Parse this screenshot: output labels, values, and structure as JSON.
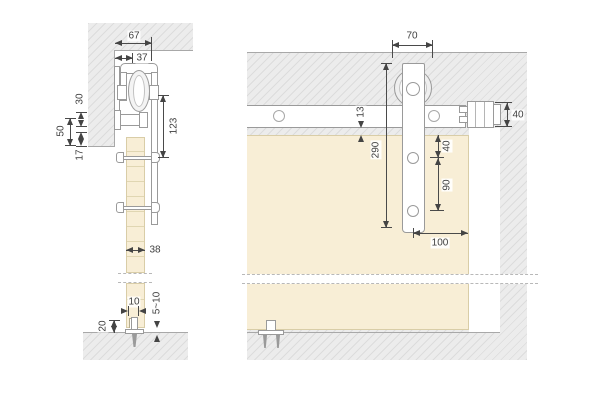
{
  "side_view": {
    "dims": {
      "top_width": "67",
      "roller_offset": "37",
      "bracket_drop": "30",
      "mount_span": "50",
      "clearance": "17",
      "hanger_length": "123",
      "door_thickness": "38",
      "groove_width": "10",
      "floor_gap": "5~10",
      "guide_height": "20"
    }
  },
  "front_view": {
    "dims": {
      "hanger_width": "70",
      "track_door_gap": "13",
      "hanger_height": "290",
      "hole_offset": "40",
      "hole_spacing": "90",
      "edge_distance": "100",
      "stop_height": "40"
    }
  },
  "colors": {
    "wall_fill": "#ececec",
    "wall_hatch_line": "#dcdcdc",
    "door_fill": "#f8eed6",
    "door_edge": "#d9cda7",
    "hardware_outline": "#9a9a9a",
    "dimension_text": "#3f3f3f"
  }
}
